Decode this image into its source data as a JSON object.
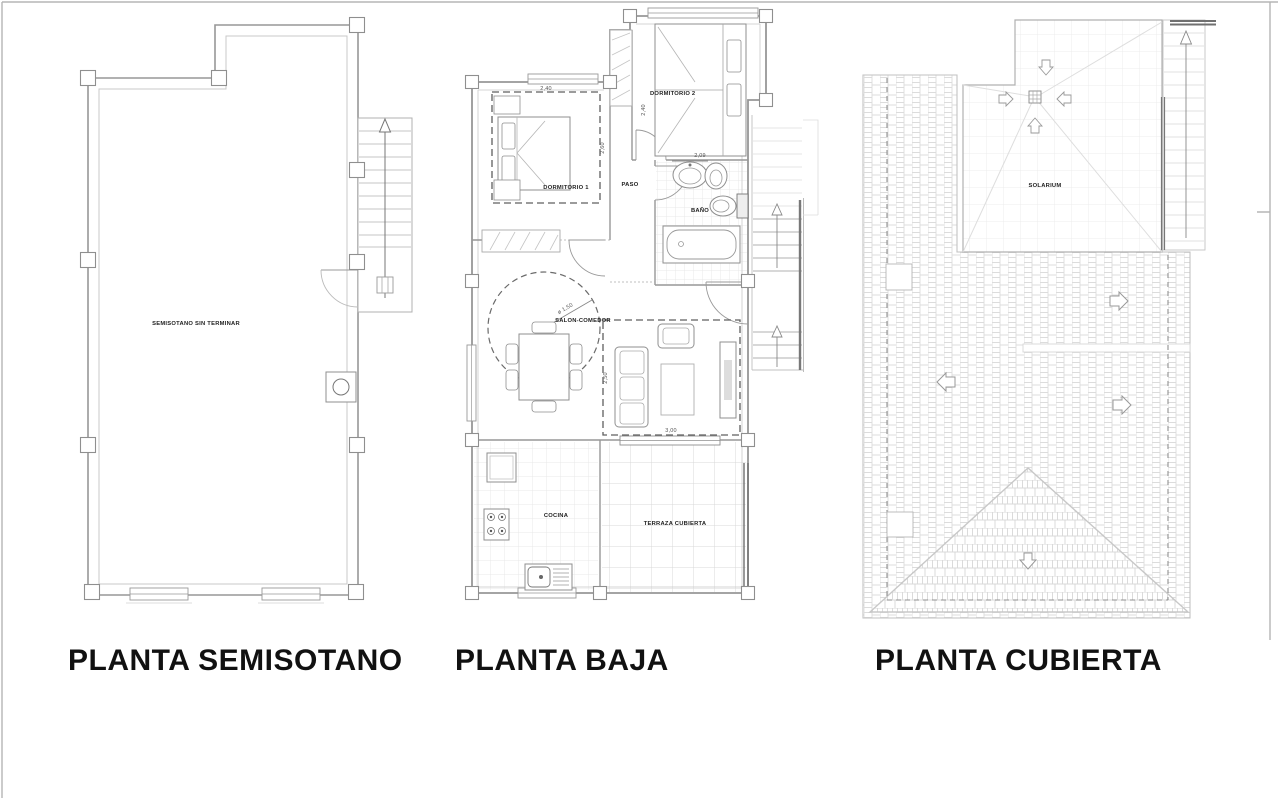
{
  "sheet": {
    "background": "#ffffff",
    "frame_color": "#a8a8a8",
    "wall_color": "#979797",
    "light_line_color": "#cccccc",
    "roof_hatch_color": "#dcdcdc",
    "text_color": "#1c1c1c"
  },
  "plans": {
    "semisotano": {
      "title": "PLANTA SEMISOTANO",
      "labels": {
        "room": "SEMISOTANO SIN TERMINAR"
      }
    },
    "baja": {
      "title": "PLANTA BAJA",
      "labels": {
        "dormitorio1": "DORMITORIO 1",
        "dormitorio2": "DORMITORIO 2",
        "paso": "PASO",
        "bano": "BAÑO",
        "salon": "SALON-COMEDOR",
        "cocina": "COCINA",
        "terraza": "TERRAZA CUBIERTA"
      },
      "dimensions": {
        "dorm1_width": "2,40",
        "dorm1_depth": "2,60",
        "dorm2_depth": "2,40",
        "dorm2_width": "2,09",
        "salon_depth": "2,50",
        "salon_width": "3,00",
        "circle_diameter": "ø 1,50"
      }
    },
    "cubierta": {
      "title": "PLANTA CUBIERTA",
      "labels": {
        "solarium": "SOLARIUM"
      }
    }
  }
}
